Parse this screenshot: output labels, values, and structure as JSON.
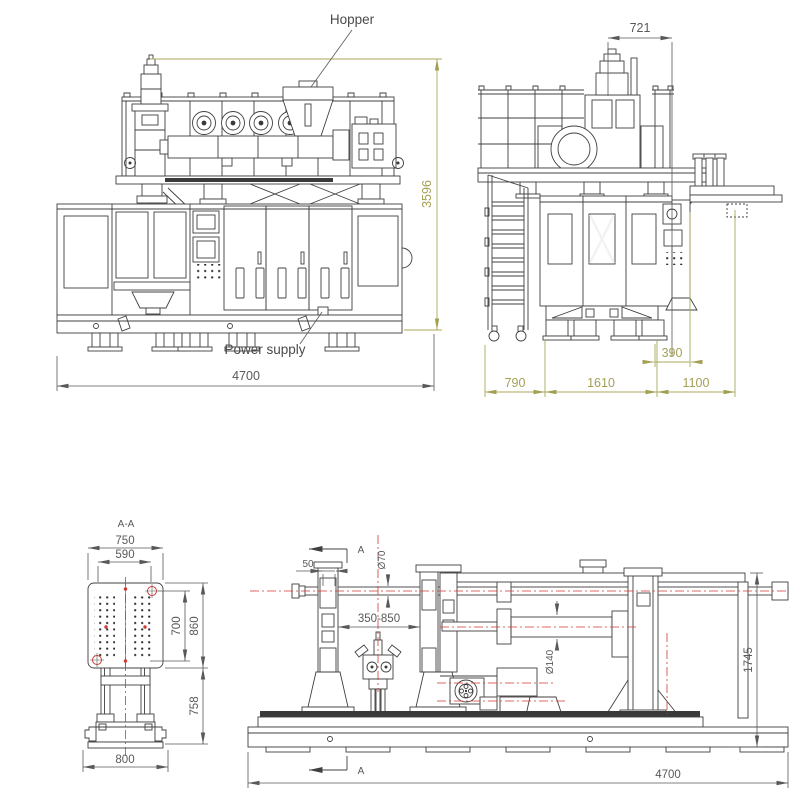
{
  "drawing": {
    "type": "engineering-drawing",
    "subject": "extrusion blow molding machine - four orthographic views",
    "colors": {
      "line": "#404040",
      "dimension_dark": "#58595b",
      "dimension_olive": "#a3a054",
      "centerline_red": "#cf3a35",
      "background": "#ffffff"
    }
  },
  "front_view": {
    "labels": {
      "hopper": "Hopper",
      "power_supply": "Power supply"
    },
    "dims": {
      "overall_height": "3596",
      "overall_width": "4700"
    }
  },
  "side_view": {
    "dims": {
      "head_offset": "721",
      "platform_overhang": "390",
      "ladder_depth": "790",
      "body_width": "1610",
      "arm_extension": "1100"
    }
  },
  "section_view": {
    "title": "A-A",
    "dims": {
      "plate_width": "750",
      "bolt_span_width": "590",
      "bolt_span_height": "700",
      "plate_height": "860",
      "leg_height": "758",
      "base_width": "800"
    }
  },
  "die_view": {
    "section_label_top": "A",
    "section_label_bottom": "A",
    "dims": {
      "offset": "50",
      "nozzle_diameter": "Ø70",
      "stroke_range": "350-850",
      "shaft_diameter": "Ø140",
      "frame_height": "1745",
      "base_length": "4700"
    }
  }
}
